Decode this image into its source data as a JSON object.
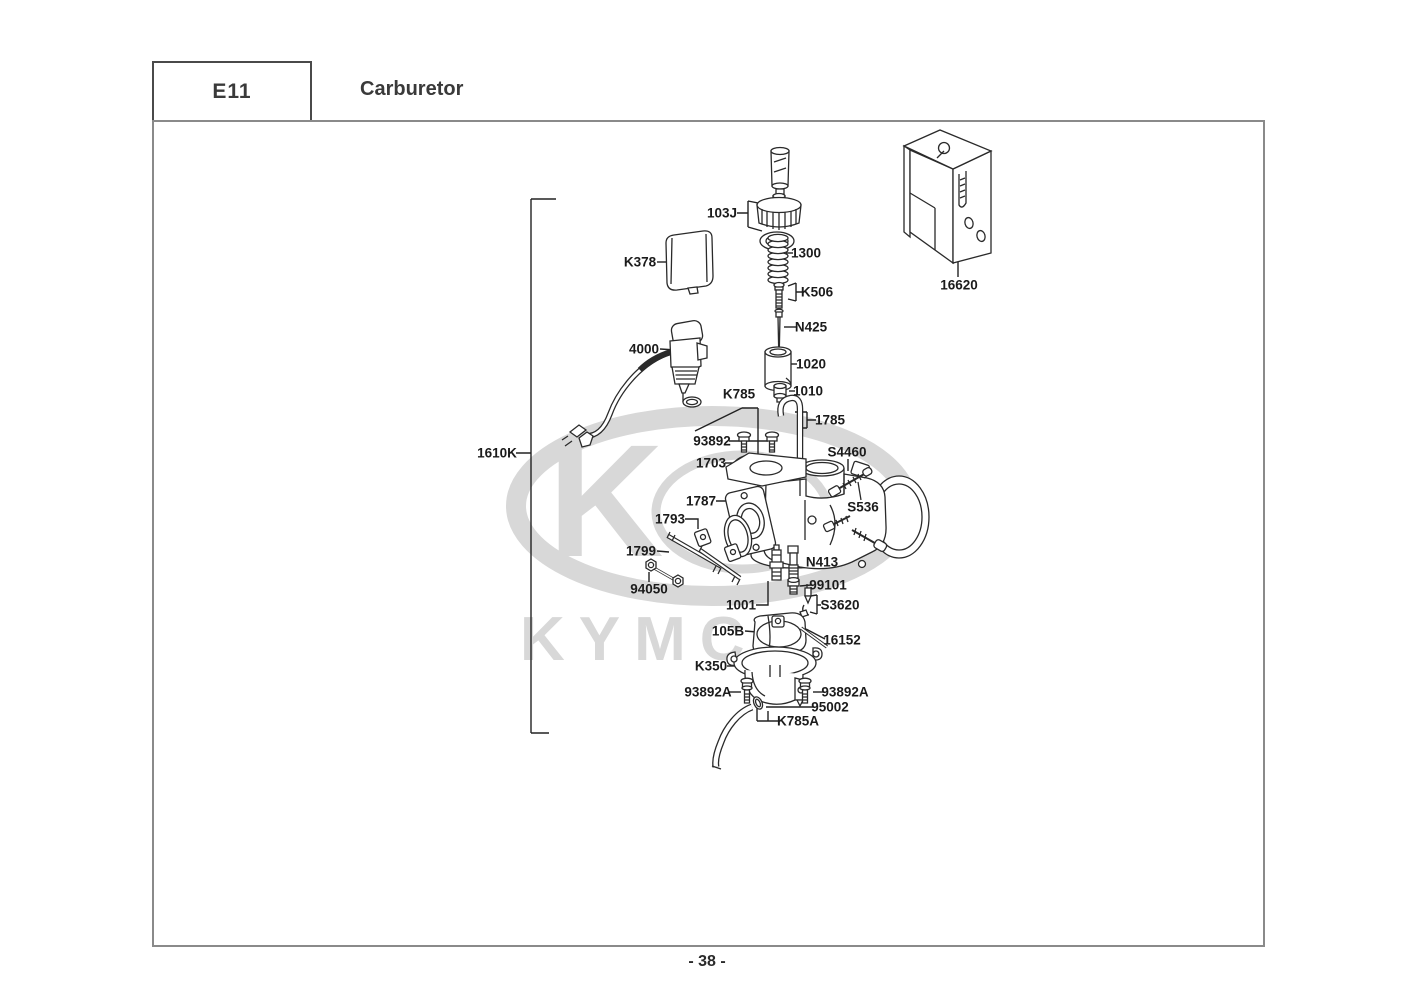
{
  "header": {
    "section_code": "E11",
    "title": "Carburetor"
  },
  "footer": {
    "page_number": "- 38 -"
  },
  "watermark": {
    "brand": "KYMCO",
    "emblem_letter": "K",
    "color": "#d8d8d8"
  },
  "diagram": {
    "part_labels": [
      {
        "text": "103J"
      },
      {
        "text": "1300"
      },
      {
        "text": "K506"
      },
      {
        "text": "N425"
      },
      {
        "text": "K378"
      },
      {
        "text": "4000"
      },
      {
        "text": "1020"
      },
      {
        "text": "1010"
      },
      {
        "text": "K785"
      },
      {
        "text": "1785"
      },
      {
        "text": "93892"
      },
      {
        "text": "1703"
      },
      {
        "text": "S4460"
      },
      {
        "text": "1787"
      },
      {
        "text": "S536"
      },
      {
        "text": "1793"
      },
      {
        "text": "1799"
      },
      {
        "text": "N413"
      },
      {
        "text": "94050"
      },
      {
        "text": "99101"
      },
      {
        "text": "1001"
      },
      {
        "text": "S3620"
      },
      {
        "text": "105B"
      },
      {
        "text": "16152"
      },
      {
        "text": "K350"
      },
      {
        "text": "93892A"
      },
      {
        "text": "93892A"
      },
      {
        "text": "95002"
      },
      {
        "text": "K785A"
      },
      {
        "text": "16620"
      },
      {
        "text": "1610K"
      }
    ]
  }
}
